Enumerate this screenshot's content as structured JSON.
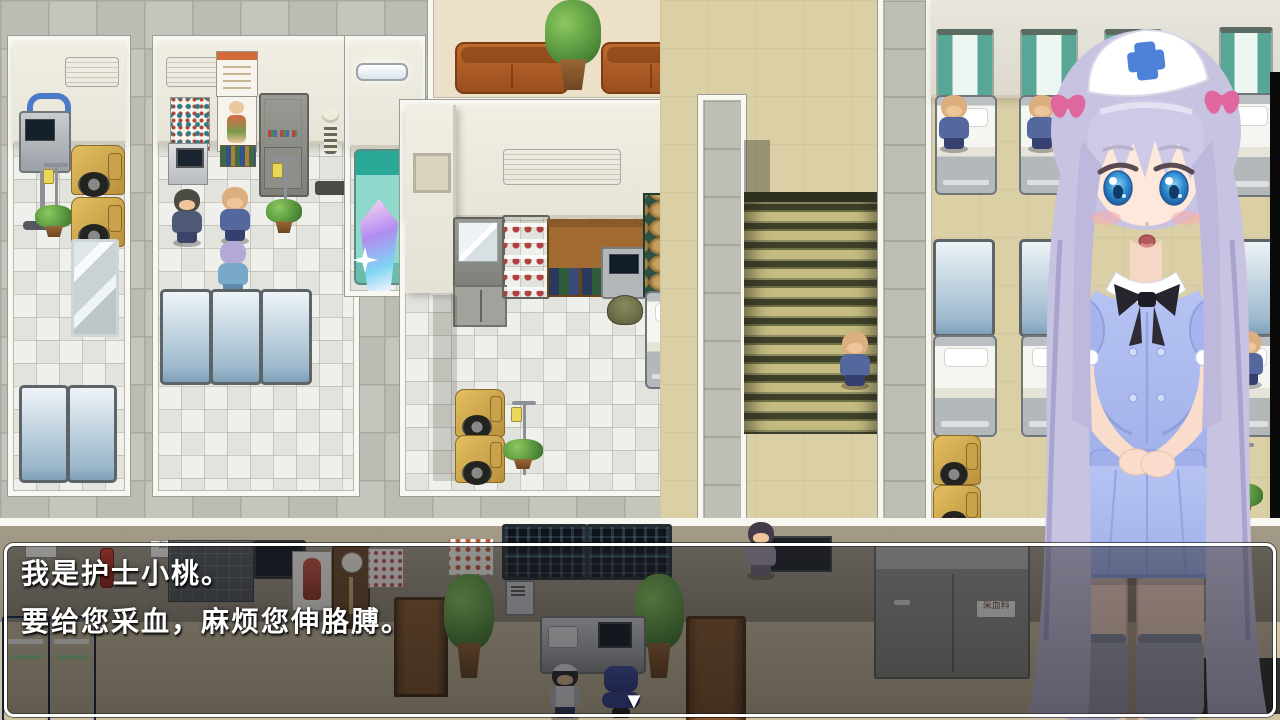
{
  "dialogue": {
    "lines": [
      "我是护士小桃。",
      "要给您采血，麻烦您伸胳膊。"
    ],
    "continue_indicator": "▼"
  },
  "signs": {
    "dept_sign_left": "采血科",
    "dept_sign_right": "采血科"
  },
  "colors": {
    "corridor": "#c6c5bd",
    "corridor_dark": "#bdbcb4",
    "grout": "#aaa9a1",
    "room_floor": "#eaeae4",
    "wall": "#f1eee4",
    "wall_edge": "#cfcabc",
    "border_white": "#f8f7f1",
    "ward_floor": "#dbcfa6",
    "waiting_floor": "#ece1c8",
    "bottom_wall": "#a39a88",
    "bottom_floor": "#cfc2a2",
    "stairs_light": "#c6bc82",
    "stairs_dark": "#3e402a",
    "curtain": "#58a796",
    "dialog_border": "#ffffff",
    "nurse_hair": "#c7c3e1",
    "nurse_hair_shade": "#a9a4cd",
    "nurse_skin": "#fde8db",
    "nurse_dress": "#aebcf0",
    "nurse_dress_shade": "#8fa0dd",
    "nurse_cross": "#4d82d8",
    "nurse_ribbon": "#e0669e",
    "nurse_stocking": "#a6a8ba"
  }
}
